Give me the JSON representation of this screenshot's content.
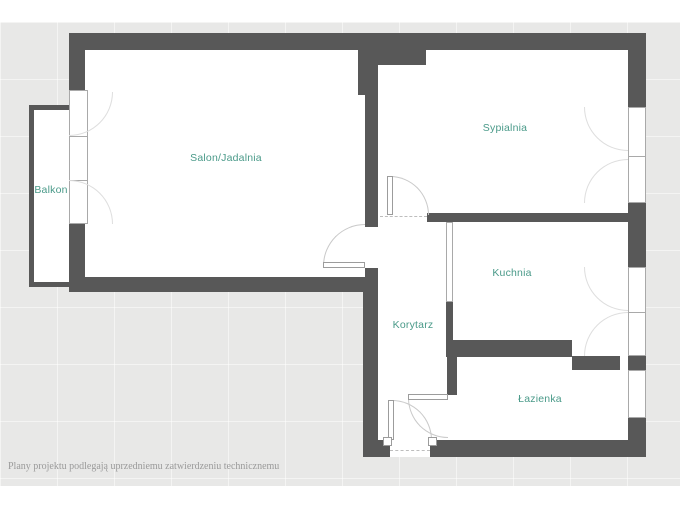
{
  "plan": {
    "rooms": [
      {
        "id": "salon",
        "label": "Salon/Jadalnia"
      },
      {
        "id": "sypialnia",
        "label": "Sypialnia"
      },
      {
        "id": "balkon",
        "label": "Balkon"
      },
      {
        "id": "kuchnia",
        "label": "Kuchnia"
      },
      {
        "id": "korytarz",
        "label": "Korytarz"
      },
      {
        "id": "lazienka",
        "label": "Łazienka"
      }
    ],
    "disclaimer": "Plany projektu podlegają uprzedniemu zatwierdzeniu technicznemu"
  },
  "colors": {
    "wall": "#585858",
    "floor": "#ffffff",
    "background": "#e8e8e7",
    "room_label": "#4a9a89",
    "disclaimer_text": "#9a9a9a",
    "window_frame": "#a9a9a9",
    "door_arc": "#c9c9c9"
  }
}
